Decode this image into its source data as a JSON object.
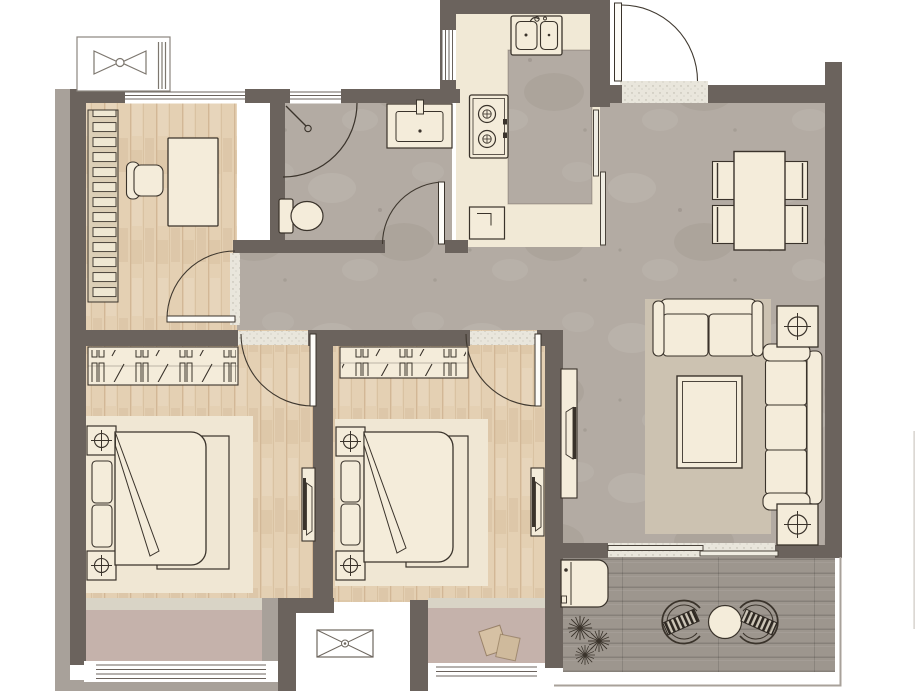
{
  "colors": {
    "wall": "#6b635d",
    "wall-light": "#a8a19a",
    "line": "#3a332b",
    "door-arc": "#3f382f",
    "wood": "#e4d0b3",
    "wood-grain": "#c9ae87",
    "tile": "#b3aba3",
    "cream": "#f4ecda",
    "kitchen-floor": "#f1e9d6",
    "rug-living": "#ccc2b1",
    "rug-bedroom": "#f0e7d4",
    "mauve": "#c5b2ab",
    "threshold": "#d9d4c6",
    "deck": "#9d968e",
    "mat": "#e9e6dc",
    "slipper": "#d6c1a4",
    "white": "#ffffff"
  },
  "floor_plan": {
    "kind": "apartment-floor-plan",
    "rooms": [
      {
        "id": "study",
        "furniture": [
          "bookshelf",
          "desk",
          "desk-chair",
          "window"
        ]
      },
      {
        "id": "bathroom",
        "furniture": [
          "shower",
          "vanity-sink",
          "toilet",
          "swing-door",
          "window"
        ]
      },
      {
        "id": "kitchen",
        "furniture": [
          "double-sink",
          "gas-stove",
          "counter",
          "base-appliance",
          "sliding-door",
          "window"
        ]
      },
      {
        "id": "entry",
        "furniture": [
          "entry-door",
          "doormat"
        ]
      },
      {
        "id": "living-dining",
        "furniture": [
          "dining-table",
          "dining-chair x4",
          "loveseat",
          "sofa",
          "coffee-table",
          "side-table x2",
          "potted-plant x2",
          "tv-console",
          "rug",
          "sliding-door"
        ]
      },
      {
        "id": "corridor",
        "furniture": []
      },
      {
        "id": "bedroom-1",
        "furniture": [
          "wardrobe",
          "double-bed",
          "nightstand x2",
          "rug",
          "tv-console",
          "swing-door"
        ]
      },
      {
        "id": "bedroom-2",
        "furniture": [
          "wardrobe",
          "double-bed",
          "nightstand x2",
          "rug",
          "tv-console",
          "swing-door",
          "slippers"
        ]
      },
      {
        "id": "balcony",
        "furniture": [
          "washing-machine",
          "plants",
          "round-table",
          "wicker-chair x2",
          "railing"
        ]
      },
      {
        "id": "bay-window-bedroom-1",
        "furniture": [
          "window"
        ]
      },
      {
        "id": "bay-window-bedroom-2",
        "furniture": [
          "window"
        ]
      },
      {
        "id": "ac-platform-north",
        "furniture": [
          "ac-outdoor-unit"
        ]
      },
      {
        "id": "ac-platform-south",
        "furniture": [
          "ac-outdoor-unit"
        ]
      }
    ]
  }
}
